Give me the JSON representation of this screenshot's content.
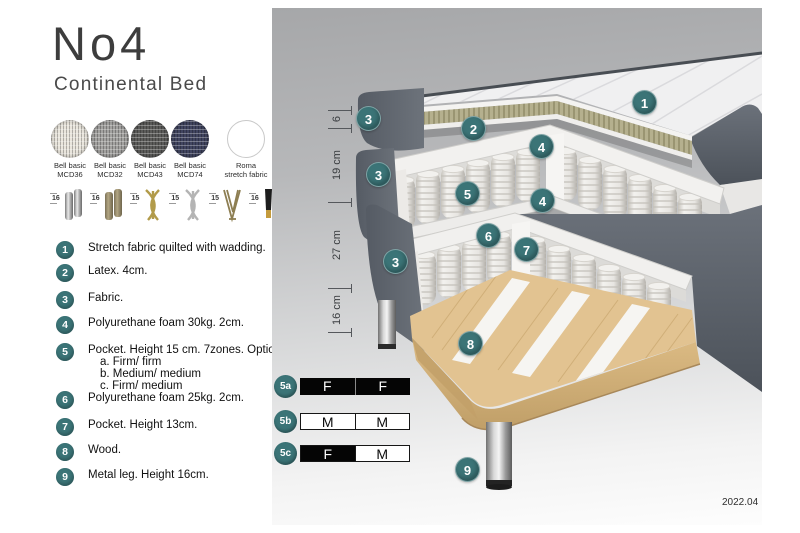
{
  "title": "No4",
  "subtitle": "Continental Bed",
  "accent_color": "#3b7477",
  "swatches": [
    {
      "line1": "Bell basic",
      "line2": "MCD36",
      "color": "#e9e5dc"
    },
    {
      "line1": "Bell basic",
      "line2": "MCD32",
      "color": "#a3a2a0"
    },
    {
      "line1": "Bell basic",
      "line2": "MCD43",
      "color": "#5c5c5a"
    },
    {
      "line1": "Bell basic",
      "line2": "MCD74",
      "color": "#414560"
    },
    {
      "line1": "Roma",
      "line2": "stretch fabric",
      "color": "#ffffff"
    }
  ],
  "legs": [
    {
      "height": "16",
      "icon": "chrome-cylinder-legs-icon"
    },
    {
      "height": "16",
      "icon": "wood-cylinder-legs-icon"
    },
    {
      "height": "15",
      "icon": "gold-twist-legs-icon"
    },
    {
      "height": "15",
      "icon": "silver-twist-legs-icon"
    },
    {
      "height": "15",
      "icon": "hairpin-leg-icon"
    },
    {
      "height": "16",
      "icon": "black-gold-legs-icon"
    }
  ],
  "features": [
    {
      "num": "1",
      "text": "Stretch fabric quilted with wadding."
    },
    {
      "num": "2",
      "text": "Latex. 4cm."
    },
    {
      "num": "3",
      "text": "Fabric."
    },
    {
      "num": "4",
      "text": "Polyurethane foam 30kg. 2cm."
    },
    {
      "num": "5",
      "text": "Pocket. Height 15 cm. 7zones. Option:",
      "options": [
        "a. Firm/ firm",
        "b. Medium/ medium",
        "c. Firm/ medium"
      ]
    },
    {
      "num": "6",
      "text": "Polyurethane foam 25kg. 2cm."
    },
    {
      "num": "7",
      "text": "Pocket. Height 13cm."
    },
    {
      "num": "8",
      "text": "Wood."
    },
    {
      "num": "9",
      "text": "Metal leg. Height 16cm."
    }
  ],
  "diagram": {
    "callouts": [
      {
        "label": "1"
      },
      {
        "label": "2"
      },
      {
        "label": "3"
      },
      {
        "label": "4"
      },
      {
        "label": "3"
      },
      {
        "label": "5"
      },
      {
        "label": "4"
      },
      {
        "label": "6"
      },
      {
        "label": "7"
      },
      {
        "label": "3"
      },
      {
        "label": "8"
      },
      {
        "label": "9"
      }
    ],
    "ruler": [
      {
        "label": "6"
      },
      {
        "label": "19 cm"
      },
      {
        "label": "27 cm"
      },
      {
        "label": "16 cm"
      }
    ],
    "firmness_options": [
      {
        "id": "5a",
        "left": "F",
        "right": "F"
      },
      {
        "id": "5b",
        "left": "M",
        "right": "M"
      },
      {
        "id": "5c",
        "left": "F",
        "right": "M"
      }
    ],
    "version": "2022.04"
  }
}
